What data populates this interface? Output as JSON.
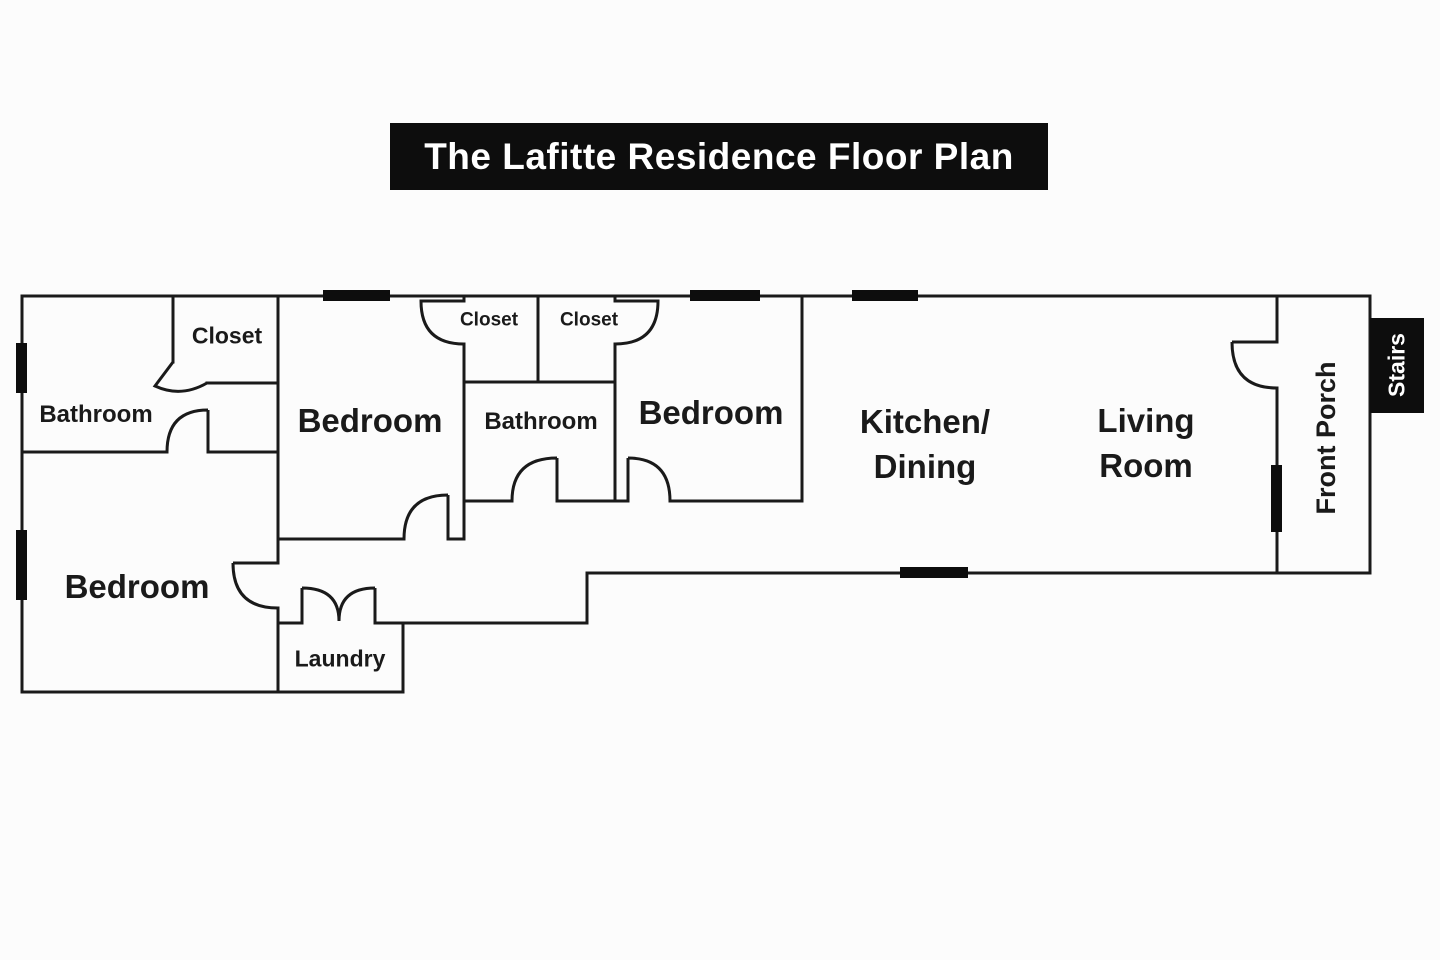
{
  "title": "The Lafitte Residence Floor Plan",
  "labels": {
    "bathroom_left": "Bathroom",
    "closet_left": "Closet",
    "bedroom_left": "Bedroom",
    "bedroom_mid": "Bedroom",
    "closet_mid_1": "Closet",
    "closet_mid_2": "Closet",
    "bathroom_mid": "Bathroom",
    "bedroom_right": "Bedroom",
    "kitchen_line1": "Kitchen/",
    "kitchen_line2": "Dining",
    "living_line1": "Living",
    "living_line2": "Room",
    "laundry": "Laundry",
    "front_porch": "Front Porch",
    "stairs": "Stairs"
  },
  "colors": {
    "wall": "#1a1a1a",
    "window_marker": "#0d0d0d",
    "background": "#fcfcfc",
    "title_bg": "#0d0d0d",
    "title_text": "#ffffff",
    "stairs_bg": "#0d0d0d",
    "stairs_text": "#ffffff",
    "label_text": "#1a1a1a"
  }
}
